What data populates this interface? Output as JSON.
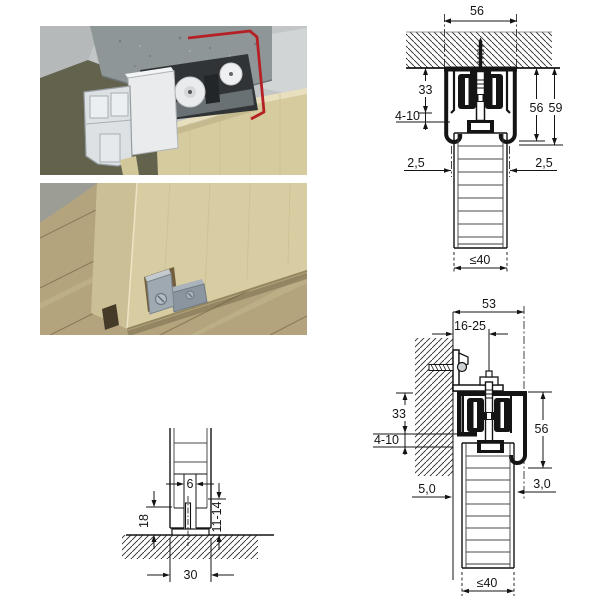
{
  "page": {
    "background": "#ffffff"
  },
  "photos": {
    "top_track_view": {
      "label": "3D detail: top roller carriage in ceiling-mounted running track",
      "door_color": "#d6ca9f",
      "concrete_color": "#8f9698",
      "aluminium_color": "#dde1e4",
      "accent_red": "#b42025"
    },
    "bottom_guide_view": {
      "label": "3D detail: bottom floor guide engaging door groove",
      "door_color": "#d8cca2",
      "floor_color": "#b4a47e",
      "guide_color": "#9fa9b2"
    }
  },
  "ceiling_section": {
    "track_width": "56",
    "rail_drop": "33",
    "vertical_adjustment": "4-10",
    "track_height": "56",
    "overall_height": "59",
    "gap_left": "2,5",
    "gap_right": "2,5",
    "max_door_thickness": "≤40"
  },
  "wall_section": {
    "track_width": "53",
    "wall_clearance": "16-25",
    "rail_drop": "33",
    "vertical_adjustment": "4-10",
    "track_height": "56",
    "wall_gap": "5,0",
    "side_gap": "3,0",
    "max_door_thickness": "≤40"
  },
  "floor_guide_section": {
    "groove_width": "6",
    "guide_height": "18",
    "engagement_depth": "11-14",
    "groove_spacing": "30"
  }
}
